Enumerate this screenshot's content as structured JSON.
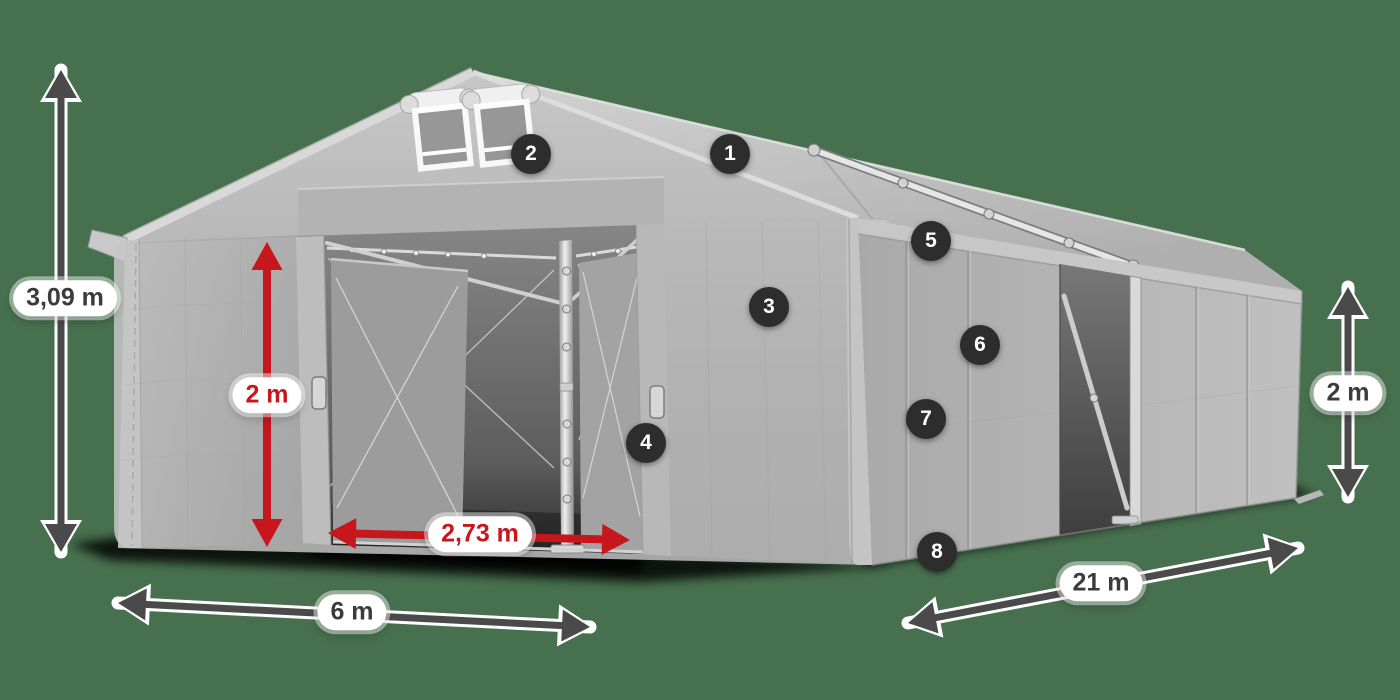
{
  "figure": {
    "background_color": "#47704e"
  },
  "colors": {
    "accent_red": "#c8161d",
    "arrow_dark": "#4a4a4a",
    "arrow_outline": "#ffffff",
    "badge_bg": "#2d2d2d",
    "badge_text": "#ffffff",
    "pill_bg": "#ffffff",
    "pill_text_dark": "#3b3b3b",
    "tent_gray": "#b5b5b5"
  },
  "badges": [
    {
      "number": "1",
      "x": 730,
      "y": 154
    },
    {
      "number": "2",
      "x": 531,
      "y": 154
    },
    {
      "number": "3",
      "x": 769,
      "y": 307
    },
    {
      "number": "4",
      "x": 646,
      "y": 443
    },
    {
      "number": "5",
      "x": 931,
      "y": 241
    },
    {
      "number": "6",
      "x": 980,
      "y": 345
    },
    {
      "number": "7",
      "x": 926,
      "y": 419
    },
    {
      "number": "8",
      "x": 937,
      "y": 552
    }
  ],
  "dimensions": [
    {
      "id": "total-height",
      "label": "3,09 m",
      "style": "dark",
      "pill": {
        "x": 65,
        "y": 298
      },
      "arrow": {
        "x1": 61,
        "y1": 552,
        "x2": 61,
        "y2": 70
      }
    },
    {
      "id": "door-height",
      "label": "2 m",
      "style": "red",
      "pill": {
        "x": 267,
        "y": 395
      },
      "arrow": {
        "x1": 267,
        "y1": 547,
        "x2": 267,
        "y2": 242
      }
    },
    {
      "id": "door-width",
      "label": "2,73 m",
      "style": "red",
      "pill": {
        "x": 480,
        "y": 534
      },
      "arrow": {
        "x1": 328,
        "y1": 533,
        "x2": 630,
        "y2": 540
      }
    },
    {
      "id": "front-width",
      "label": "6 m",
      "style": "dark",
      "pill": {
        "x": 352,
        "y": 612
      },
      "arrow": {
        "x1": 118,
        "y1": 603,
        "x2": 590,
        "y2": 627
      }
    },
    {
      "id": "side-length",
      "label": "21 m",
      "style": "dark",
      "pill": {
        "x": 1101,
        "y": 583
      },
      "arrow": {
        "x1": 908,
        "y1": 623,
        "x2": 1298,
        "y2": 548
      }
    },
    {
      "id": "side-height",
      "label": "2 m",
      "style": "dark",
      "pill": {
        "x": 1348,
        "y": 393
      },
      "arrow": {
        "x1": 1348,
        "y1": 497,
        "x2": 1348,
        "y2": 287
      }
    }
  ]
}
